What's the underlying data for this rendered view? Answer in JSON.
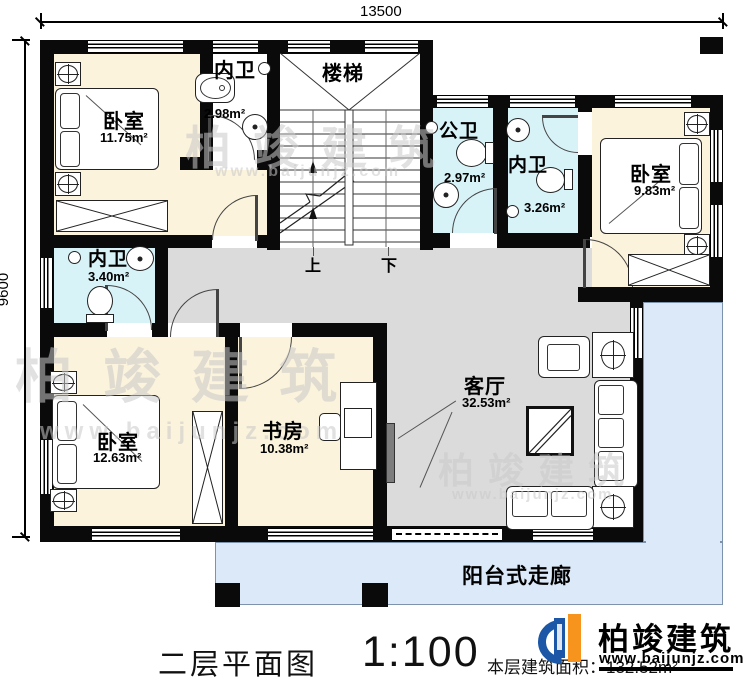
{
  "dimensions": {
    "top": "13500",
    "left": "9600"
  },
  "rooms": {
    "bedroom_tl": {
      "name": "卧室",
      "area": "11.75m²"
    },
    "bath_tl": {
      "name": "内卫",
      "area": "2.98m²"
    },
    "stairs": {
      "name": "楼梯"
    },
    "public_bath": {
      "name": "公卫",
      "area": "2.97m²"
    },
    "bath_right": {
      "name": "内卫",
      "area": "3.26m²"
    },
    "bedroom_r": {
      "name": "卧室",
      "area": "9.83m²"
    },
    "bath_left": {
      "name": "内卫",
      "area": "3.40m²"
    },
    "bedroom_bl": {
      "name": "卧室",
      "area": "12.63m²"
    },
    "study": {
      "name": "书房",
      "area": "10.38m²"
    },
    "living": {
      "name": "客厅",
      "area": "32.53m²"
    },
    "balcony": {
      "name": "阳台式走廊"
    }
  },
  "stair_labels": {
    "up": "上",
    "down": "下"
  },
  "footer": {
    "title": "二层平面图",
    "scale": "1:100",
    "area_note": "本层建筑面积：132.52m²"
  },
  "logo": {
    "name": "柏竣建筑",
    "url": "www.baijunjz.com"
  },
  "watermark": {
    "name": "柏竣建筑",
    "url": "www.baijunjz.com"
  },
  "colors": {
    "room_cream": "#fbf3dc",
    "bath_blue": "#d8f3f8",
    "hall_gray": "#dcdbdb",
    "balcony_blue": "#dce9f8",
    "wall": "#0a0a0a",
    "logo_blue": "#1b57a6",
    "logo_orange": "#f7941d"
  }
}
